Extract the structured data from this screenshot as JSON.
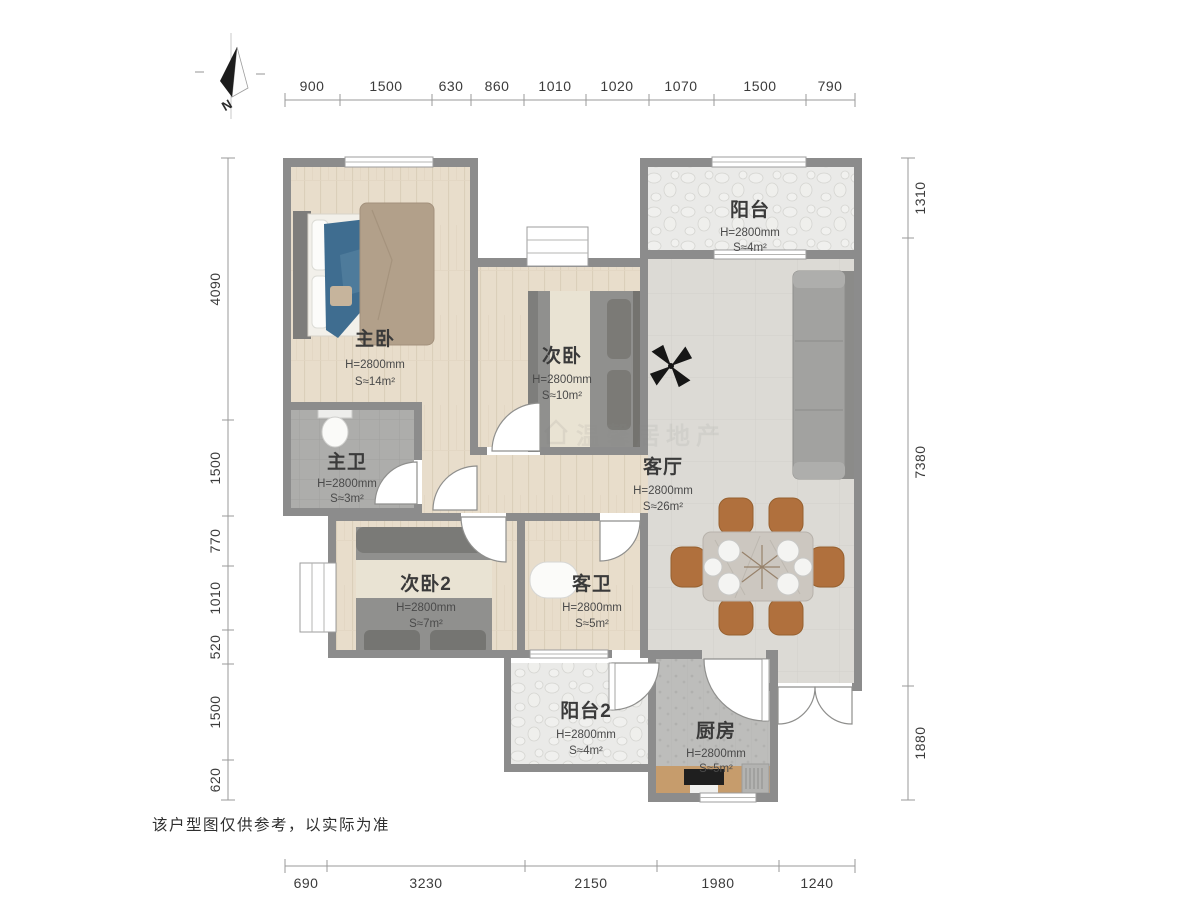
{
  "meta": {
    "disclaimer": "该户型图仅供参考，以实际为准",
    "watermark": "温馨居地产",
    "north_label": "N"
  },
  "dimensions": {
    "top": [
      "900",
      "1500",
      "630",
      "860",
      "1010",
      "1020",
      "1070",
      "1500",
      "790"
    ],
    "left": [
      "4090",
      "1500",
      "770",
      "1010",
      "520",
      "1500",
      "620"
    ],
    "right": [
      "1310",
      "7380",
      "1880"
    ],
    "bottom": [
      "690",
      "3230",
      "2150",
      "1980",
      "1240"
    ]
  },
  "rooms": [
    {
      "name": "主卧",
      "height": "H=2800mm",
      "area": "S≈14m²"
    },
    {
      "name": "次卧",
      "height": "H=2800mm",
      "area": "S≈10m²"
    },
    {
      "name": "阳台",
      "height": "H=2800mm",
      "area": "S≈4m²"
    },
    {
      "name": "主卫",
      "height": "H=2800mm",
      "area": "S≈3m²"
    },
    {
      "name": "客厅",
      "height": "H=2800mm",
      "area": "S≈26m²"
    },
    {
      "name": "次卧2",
      "height": "H=2800mm",
      "area": "S≈7m²"
    },
    {
      "name": "客卫",
      "height": "H=2800mm",
      "area": "S≈5m²"
    },
    {
      "name": "阳台2",
      "height": "H=2800mm",
      "area": "S≈4m²"
    },
    {
      "name": "厨房",
      "height": "H=2800mm",
      "area": "S≈5m²"
    }
  ],
  "colors": {
    "wall": "#8c8c8c",
    "wood_floor": "#e8ddcb",
    "living_floor": "#dcdad5",
    "bath_tile": "#adadab",
    "balcony_floor": "#eaeae8",
    "kitchen_floor": "#bdbdbb",
    "bed_blanket_blue": "#3f6d90",
    "duvet_tan": "#b2a08a",
    "bed_grey": "#90908e",
    "sofa_grey": "#a2a2a0",
    "chair_brown": "#b0703d",
    "counter_wood": "#c69c6c"
  }
}
